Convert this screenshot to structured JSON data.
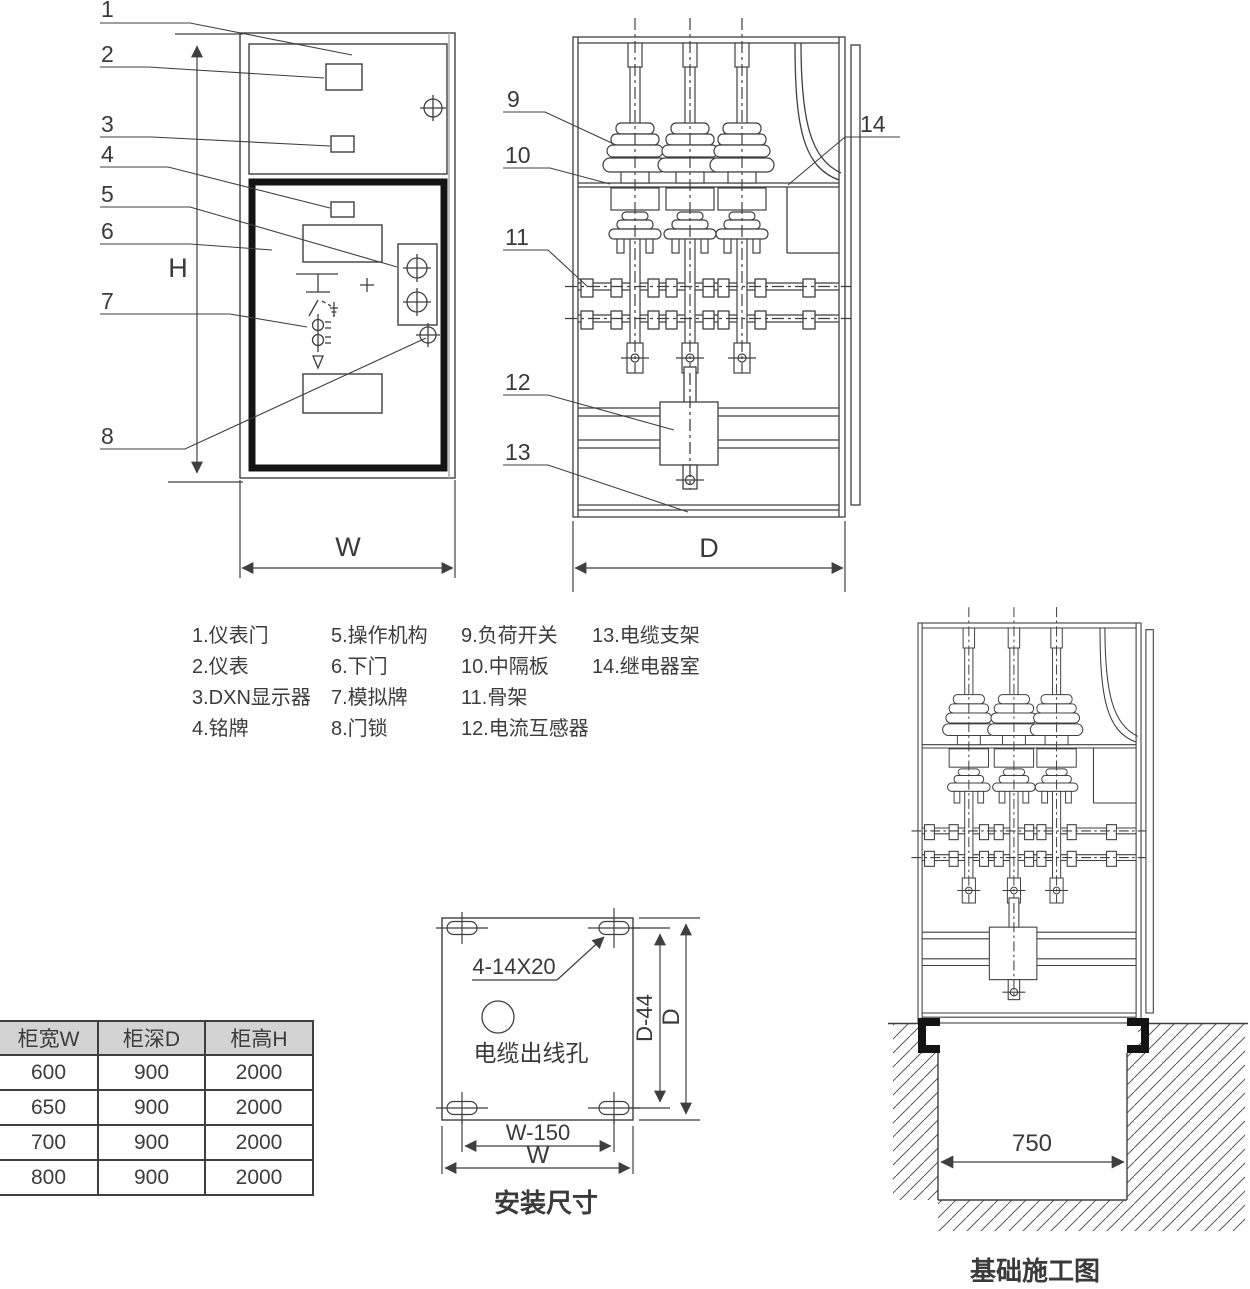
{
  "front_view": {
    "callouts": [
      "1",
      "2",
      "3",
      "4",
      "5",
      "6",
      "7",
      "8"
    ],
    "height_label": "H",
    "width_label": "W"
  },
  "side_view": {
    "callouts": [
      "9",
      "10",
      "11",
      "12",
      "13",
      "14"
    ],
    "depth_label": "D"
  },
  "legend": {
    "columns": [
      {
        "items": [
          "1.仪表门",
          "2.仪表",
          "3.DXN显示器",
          "4.铭牌"
        ]
      },
      {
        "items": [
          "5.操作机构",
          "6.下门",
          "7.模拟牌",
          "8.门锁"
        ]
      },
      {
        "items": [
          "9.负荷开关",
          "10.中隔板",
          "11.骨架",
          "12.电流互感器"
        ]
      },
      {
        "items": [
          "13.电缆支架",
          "14.继电器室"
        ]
      }
    ]
  },
  "size_table": {
    "headers": [
      "柜宽W",
      "柜深D",
      "柜高H"
    ],
    "rows": [
      [
        "600",
        "900",
        "2000"
      ],
      [
        "650",
        "900",
        "2000"
      ],
      [
        "700",
        "900",
        "2000"
      ],
      [
        "800",
        "900",
        "2000"
      ]
    ]
  },
  "install_diagram": {
    "bolt_label": "4-14X20",
    "hole_label": "电缆出线孔",
    "dim_inner_width": "W-150",
    "dim_width": "W",
    "dim_inner_depth": "D-44",
    "dim_depth": "D",
    "title": "安装尺寸"
  },
  "foundation_diagram": {
    "pit_width": "750",
    "title": "基础施工图"
  },
  "colors": {
    "line": "#3f3f3f",
    "thick_border": "#141414",
    "table_header_bg": "#d3d3d3"
  }
}
